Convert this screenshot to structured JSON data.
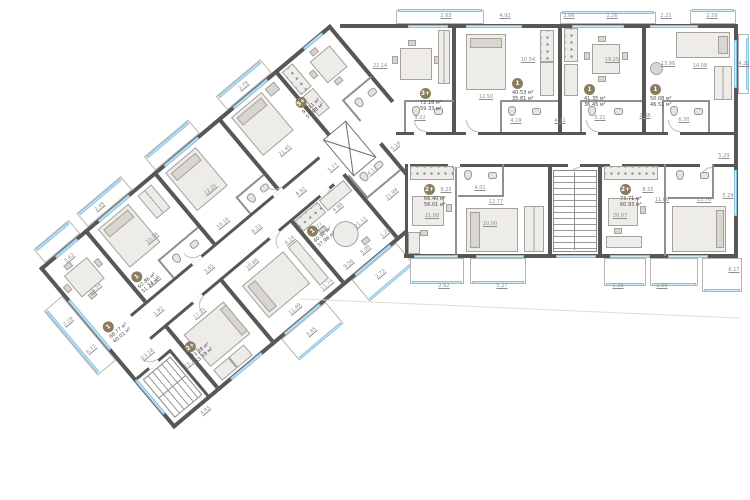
{
  "palette": {
    "wall": "#575757",
    "partition": "#8f8f8f",
    "window_glazing": "#cdeaf7",
    "window_frame": "#8cc2de",
    "furniture": "#edece9",
    "unit_badge": "#8b7c5e",
    "dim_text": "#8f8f8f",
    "area_text": "#4c4c4c",
    "background": "#ffffff"
  },
  "units": [
    {
      "label": "5+",
      "area_total": "93.11 м²",
      "area_living": "57.98 м²",
      "layer": "l",
      "x": 302,
      "y": 36
    },
    {
      "label": "1",
      "area_total": "62.86 м²",
      "area_living": "51.24 м²",
      "layer": "l",
      "x": 64,
      "y": 64
    },
    {
      "label": "1",
      "area_total": "68.77 м²",
      "area_living": "60.01 м²",
      "layer": "l",
      "x": 10,
      "y": 84
    },
    {
      "label": "1",
      "area_total": "40.92 м²",
      "area_living": "37.96 м²",
      "layer": "l",
      "x": 228,
      "y": 142
    },
    {
      "label": "2+",
      "area_total": "73.28 м²",
      "area_living": "63.59 м²",
      "layer": "l",
      "x": 60,
      "y": 152
    },
    {
      "label": "3+",
      "area_total": "72.16 м²",
      "area_living": "59.33 м²",
      "layer": "r",
      "x": 420,
      "y": 88
    },
    {
      "label": "1",
      "area_total": "40.53 м²",
      "area_living": "35.81 м²",
      "layer": "r",
      "x": 512,
      "y": 78
    },
    {
      "label": "1",
      "area_total": "41.35 м²",
      "area_living": "36.45 м²",
      "layer": "r",
      "x": 584,
      "y": 84
    },
    {
      "label": "1",
      "area_total": "50.08 м²",
      "area_living": "46.51 м²",
      "layer": "r",
      "x": 650,
      "y": 84
    },
    {
      "label": "2+",
      "area_total": "66.40 м²",
      "area_living": "56.01 м²",
      "layer": "r",
      "x": 424,
      "y": 184
    },
    {
      "label": "2+",
      "area_total": "73.71 м²",
      "area_living": "60.93 м²",
      "layer": "r",
      "x": 620,
      "y": 184
    }
  ],
  "dims": [
    {
      "t": "2.63",
      "layer": "r",
      "x": 446,
      "y": 16
    },
    {
      "t": "4.92",
      "layer": "r",
      "x": 505,
      "y": 16
    },
    {
      "t": "2.66",
      "layer": "r",
      "x": 569,
      "y": 16
    },
    {
      "t": "2.26",
      "layer": "r",
      "x": 612,
      "y": 16
    },
    {
      "t": "2.21",
      "layer": "r",
      "x": 666,
      "y": 16
    },
    {
      "t": "2.59",
      "layer": "r",
      "x": 712,
      "y": 16
    },
    {
      "t": "4.22",
      "layer": "r",
      "x": 744,
      "y": 64
    },
    {
      "t": "22.14",
      "layer": "r",
      "x": 380,
      "y": 66
    },
    {
      "t": "12.50",
      "layer": "r",
      "x": 486,
      "y": 97
    },
    {
      "t": "10.54",
      "layer": "r",
      "x": 528,
      "y": 60
    },
    {
      "t": "19.25",
      "layer": "r",
      "x": 612,
      "y": 60
    },
    {
      "t": "13.96",
      "layer": "r",
      "x": 668,
      "y": 64
    },
    {
      "t": "14.08",
      "layer": "r",
      "x": 700,
      "y": 66
    },
    {
      "t": "4.19",
      "layer": "r",
      "x": 516,
      "y": 121
    },
    {
      "t": "4.21",
      "layer": "r",
      "x": 560,
      "y": 121
    },
    {
      "t": "5.21",
      "layer": "r",
      "x": 600,
      "y": 118
    },
    {
      "t": "1.48",
      "layer": "r",
      "x": 645,
      "y": 116
    },
    {
      "t": "6.30",
      "layer": "r",
      "x": 684,
      "y": 120
    },
    {
      "t": "9.02",
      "layer": "r",
      "x": 420,
      "y": 118
    },
    {
      "t": "9.25",
      "layer": "r",
      "x": 446,
      "y": 190
    },
    {
      "t": "21.08",
      "layer": "r",
      "x": 432,
      "y": 216
    },
    {
      "t": "10.00",
      "layer": "r",
      "x": 490,
      "y": 224
    },
    {
      "t": "12.77",
      "layer": "r",
      "x": 496,
      "y": 202
    },
    {
      "t": "4.01",
      "layer": "r",
      "x": 480,
      "y": 188
    },
    {
      "t": "2.62",
      "layer": "r",
      "x": 444,
      "y": 286
    },
    {
      "t": "5.27",
      "layer": "r",
      "x": 502,
      "y": 286
    },
    {
      "t": "8.55",
      "layer": "r",
      "x": 648,
      "y": 190
    },
    {
      "t": "20.97",
      "layer": "r",
      "x": 620,
      "y": 216
    },
    {
      "t": "11.66",
      "layer": "r",
      "x": 662,
      "y": 200
    },
    {
      "t": "13.76",
      "layer": "r",
      "x": 704,
      "y": 200
    },
    {
      "t": "5.29",
      "layer": "r",
      "x": 724,
      "y": 156
    },
    {
      "t": "5.29",
      "layer": "r",
      "x": 728,
      "y": 196
    },
    {
      "t": "1.29",
      "layer": "r",
      "x": 618,
      "y": 286
    },
    {
      "t": "2.59",
      "layer": "r",
      "x": 662,
      "y": 286
    },
    {
      "t": "6.17",
      "layer": "r",
      "x": 734,
      "y": 270
    },
    {
      "t": "5.62",
      "layer": "l",
      "x": 30,
      "y": 12
    },
    {
      "t": "16.54",
      "layer": "l",
      "x": 30,
      "y": 52
    },
    {
      "t": "10.58",
      "layer": "l",
      "x": 106,
      "y": 50
    },
    {
      "t": "12.25",
      "layer": "l",
      "x": 182,
      "y": 50
    },
    {
      "t": "21.45",
      "layer": "l",
      "x": 264,
      "y": 68
    },
    {
      "t": "11.16",
      "layer": "l",
      "x": 80,
      "y": 84
    },
    {
      "t": "10.16",
      "layer": "l",
      "x": 170,
      "y": 84
    },
    {
      "t": "1.92",
      "layer": "l",
      "x": 64,
      "y": 110
    },
    {
      "t": "3.65",
      "layer": "l",
      "x": 130,
      "y": 110
    },
    {
      "t": "8.23",
      "layer": "l",
      "x": 192,
      "y": 110
    },
    {
      "t": "8.92",
      "layer": "l",
      "x": 250,
      "y": 110
    },
    {
      "t": "5.77",
      "layer": "l",
      "x": 290,
      "y": 112
    },
    {
      "t": "13.18",
      "layer": "l",
      "x": 28,
      "y": 136
    },
    {
      "t": "17.25",
      "layer": "l",
      "x": 94,
      "y": 138
    },
    {
      "t": "15.2",
      "layer": "l",
      "x": 54,
      "y": 170
    },
    {
      "t": "11.99",
      "layer": "l",
      "x": 170,
      "y": 196
    },
    {
      "t": "10.66",
      "layer": "l",
      "x": 166,
      "y": 134
    },
    {
      "t": "11.74",
      "layer": "l",
      "x": 210,
      "y": 198
    },
    {
      "t": "21.12",
      "layer": "l",
      "x": 276,
      "y": 172
    },
    {
      "t": "9.56",
      "layer": "l",
      "x": 240,
      "y": 196
    },
    {
      "t": "21.99",
      "layer": "l",
      "x": 318,
      "y": 170
    },
    {
      "t": "4.99",
      "layer": "l",
      "x": 268,
      "y": 146
    },
    {
      "t": "4.17",
      "layer": "l",
      "x": 318,
      "y": 140
    },
    {
      "t": "5.16",
      "layer": "l",
      "x": 352,
      "y": 136
    },
    {
      "t": "4.14",
      "layer": "l",
      "x": 210,
      "y": 140
    },
    {
      "t": "1.77",
      "layer": "l",
      "x": 240,
      "y": 148
    },
    {
      "t": "5.08",
      "layer": "l",
      "x": 262,
      "y": 196
    },
    {
      "t": "1.29",
      "layer": "l",
      "x": 288,
      "y": 196
    },
    {
      "t": "2.48",
      "layer": "l",
      "x": 86,
      "y": -8
    },
    {
      "t": "2.79",
      "layer": "l",
      "x": 274,
      "y": -8
    },
    {
      "t": "2.19",
      "layer": "l",
      "x": -12,
      "y": 60
    },
    {
      "t": "6.77",
      "layer": "l",
      "x": -12,
      "y": 96
    },
    {
      "t": "5.65",
      "layer": "l",
      "x": 168,
      "y": 224
    },
    {
      "t": "2.72",
      "layer": "l",
      "x": 258,
      "y": 224
    },
    {
      "t": "4.43",
      "layer": "l",
      "x": 36,
      "y": 216
    }
  ]
}
